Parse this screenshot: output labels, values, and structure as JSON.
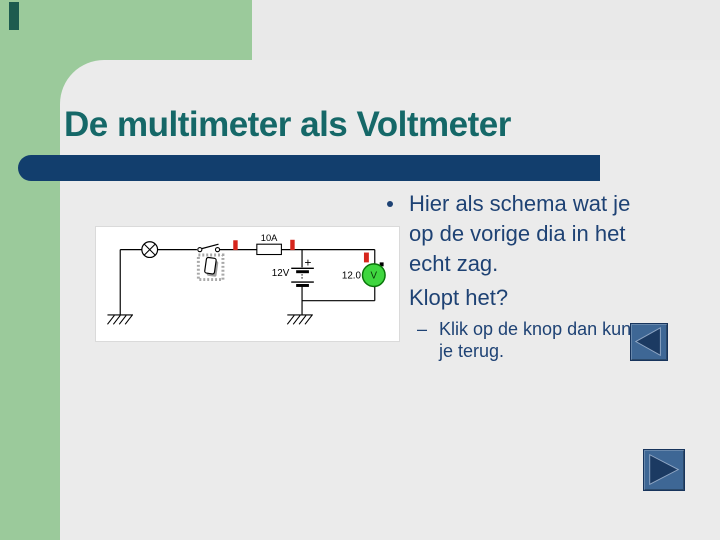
{
  "slide": {
    "title": "De multimeter als Voltmeter",
    "para1": [
      "Hier als schema wat je",
      "op de vorige dia in het",
      "echt zag."
    ],
    "para2": "Klopt het?",
    "sub_dash": "–",
    "sub_lines": [
      "Klik op de knop dan kun",
      "je terug."
    ]
  },
  "circuit": {
    "fuse_label": "10A",
    "battery_label": "12V",
    "plus_sign": "+",
    "meter_reading": "12.0",
    "meter_letter": "V"
  },
  "colors": {
    "background_green": "#9BCA9B",
    "canvas_gray": "#E9E9E9",
    "accent_dark": "#1D5B4F",
    "title_teal": "#156868",
    "divider_navy": "#123E6D",
    "text_navy": "#1E4274",
    "button_blue": "#3E6795",
    "arrow_navy": "#1B3A62",
    "mark_red": "#D6251C",
    "meter_green": "#3FD63F"
  }
}
